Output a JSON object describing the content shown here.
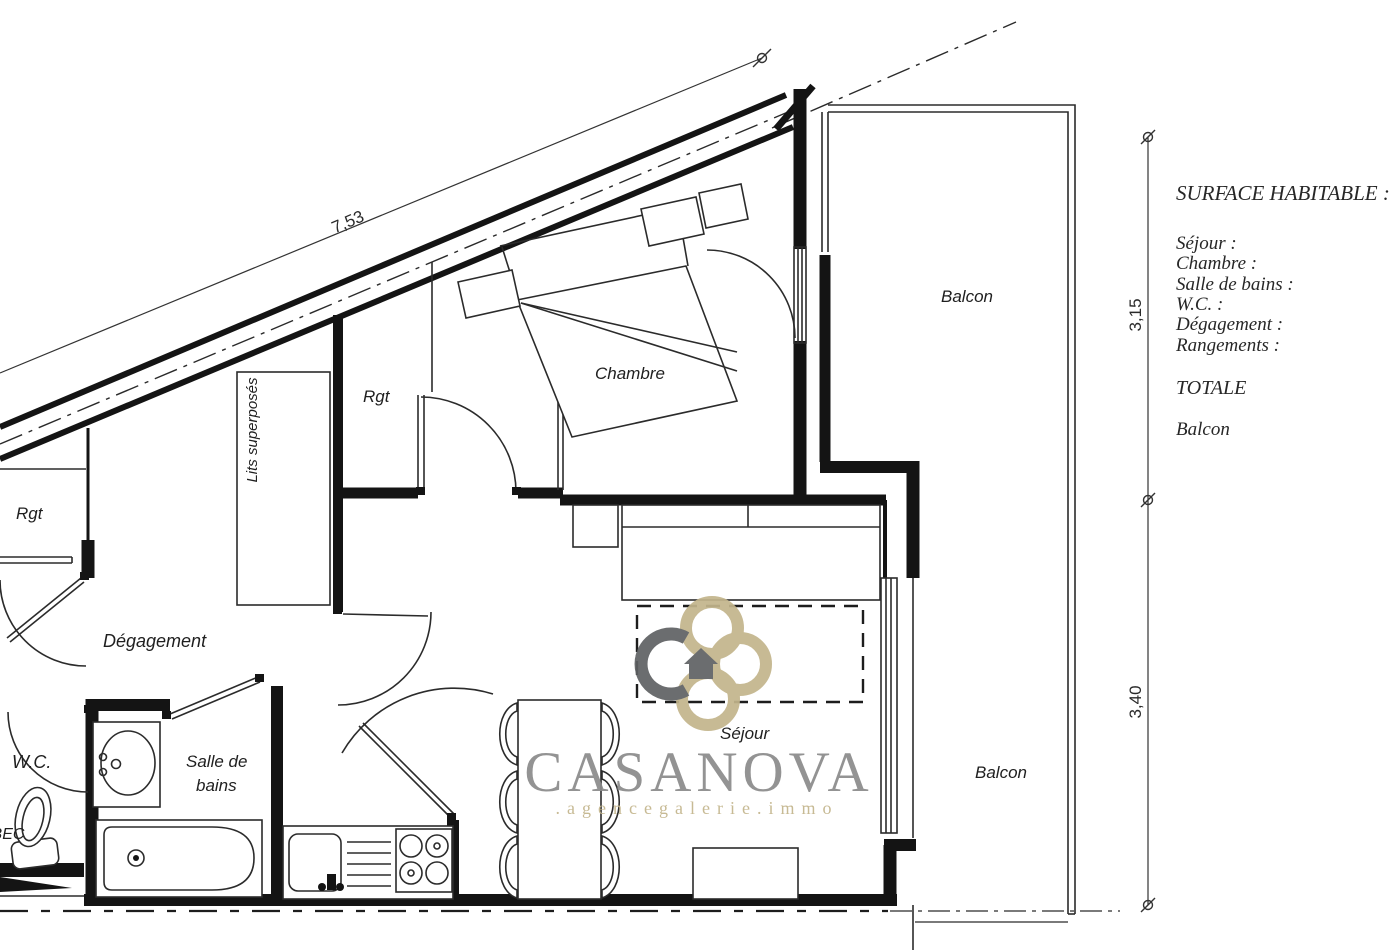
{
  "plan": {
    "room_labels": {
      "chambre": "Chambre",
      "sejour": "Séjour",
      "degagement": "Dégagement",
      "wc": "W.C.",
      "salle_de_bains_line1": "Salle de",
      "salle_de_bains_line2": "bains",
      "rgt_top": "Rgt",
      "rgt_left": "Rgt",
      "lits_superposes": "Lits superposés",
      "balcon_upper": "Balcon",
      "balcon_lower": "Balcon",
      "bec_partial": "BEC"
    },
    "dimensions": {
      "diagonal_wall": "7,53",
      "balcony_upper_height": "3,15",
      "balcony_lower_height": "3,40"
    }
  },
  "legend": {
    "title": "SURFACE HABITABLE :",
    "items": [
      "Séjour :",
      "Chambre :",
      "Salle de bains :",
      "W.C. :",
      "Dégagement :",
      "Rangements :"
    ],
    "total_label": "TOTALE",
    "balcony_label": "Balcon"
  },
  "watermark": {
    "brand": "CASANOVA",
    "tagline": ".agencegalerie.immo",
    "colors": {
      "gray": "#8a8a8a",
      "gold": "#c3b58c",
      "dark": "#5f6163"
    }
  },
  "canvas": {
    "background": "#ffffff",
    "line_color": "#141414"
  }
}
